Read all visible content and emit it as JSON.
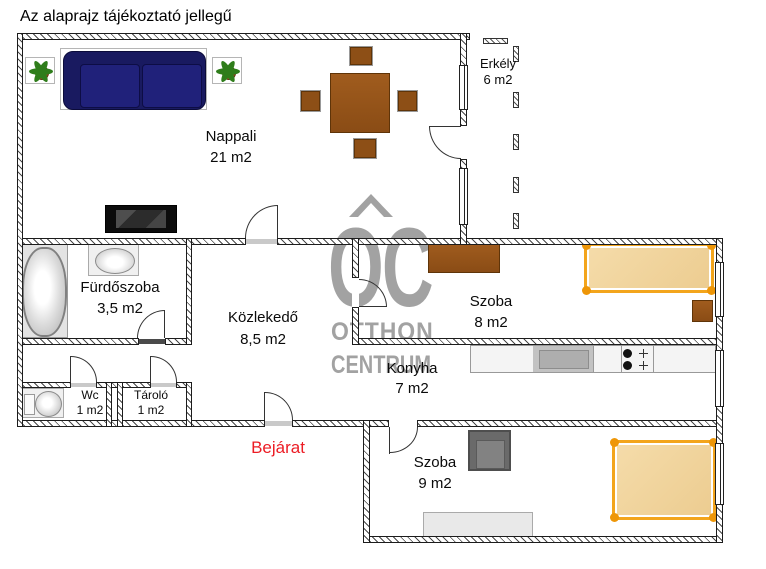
{
  "title": "Az alaprajz tájékoztató jellegű",
  "entrance_label": "Bejárat",
  "rooms": {
    "nappali": {
      "name": "Nappali",
      "area": "21 m2"
    },
    "erkely": {
      "name": "Erkély",
      "area": "6 m2"
    },
    "furdoszoba": {
      "name": "Fürdőszoba",
      "area": "3,5 m2"
    },
    "kozlekedo": {
      "name": "Közlekedő",
      "area": "8,5 m2"
    },
    "szoba8": {
      "name": "Szoba",
      "area": "8 m2"
    },
    "konyha": {
      "name": "Konyha",
      "area": "7 m2"
    },
    "wc": {
      "name": "Wc",
      "area": "1 m2"
    },
    "tarolo": {
      "name": "Tároló",
      "area": "1 m2"
    },
    "szoba9": {
      "name": "Szoba",
      "area": "9 m2"
    }
  },
  "watermark": {
    "monogram": "OC",
    "line1": "OTTHON",
    "line2": "CENTRUM"
  },
  "furniture_items": [
    "sofa",
    "potted-plant",
    "dining-table",
    "chair",
    "tv",
    "bathtub",
    "washbasin",
    "toilet",
    "kitchen-counter",
    "kitchen-sink",
    "stove",
    "dresser",
    "bed",
    "nightstand",
    "armchair",
    "sideboard"
  ],
  "colors": {
    "wall_line": "#1c1c1c",
    "wood_brown": "#955418",
    "sofa_navy": "#191a60",
    "bed_frame_orange": "#f3a51c",
    "bed_fill_tan": "#f0d49e",
    "entrance_red": "#ec1c24",
    "watermark_gray": "#a2a2a2",
    "counter_gray": "#c2c2c2"
  }
}
